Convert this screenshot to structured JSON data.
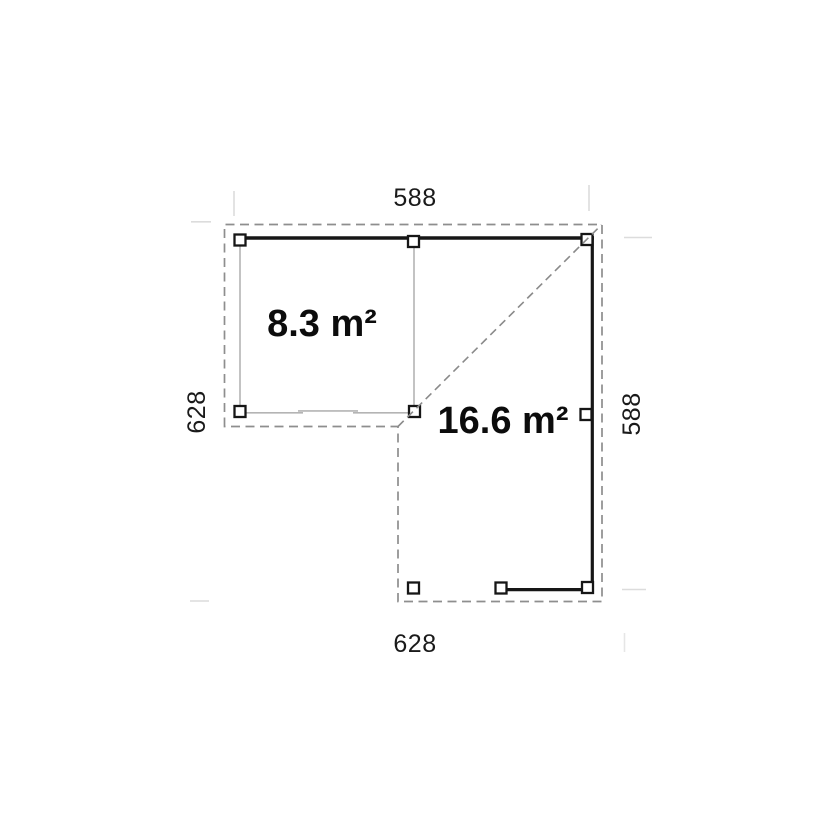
{
  "diagram": {
    "type": "floor-plan",
    "dimensions": {
      "top": "588",
      "right": "588",
      "bottom": "628",
      "left": "628"
    },
    "areas": {
      "room": "8.3 m²",
      "terrace": "16.6 m²"
    },
    "colors": {
      "structure": "#161616",
      "outline_dash": "#8e8e8e",
      "ridge_dash": "#8a8a8a",
      "wall_thin": "#b4b4b4",
      "extension": "#dcdcdc",
      "extension_faint": "#e6e6e6",
      "dimension_text": "#1a1a1a",
      "area_text": "#0c0c0c",
      "post_fill": "#ffffff",
      "background": "#ffffff"
    }
  }
}
